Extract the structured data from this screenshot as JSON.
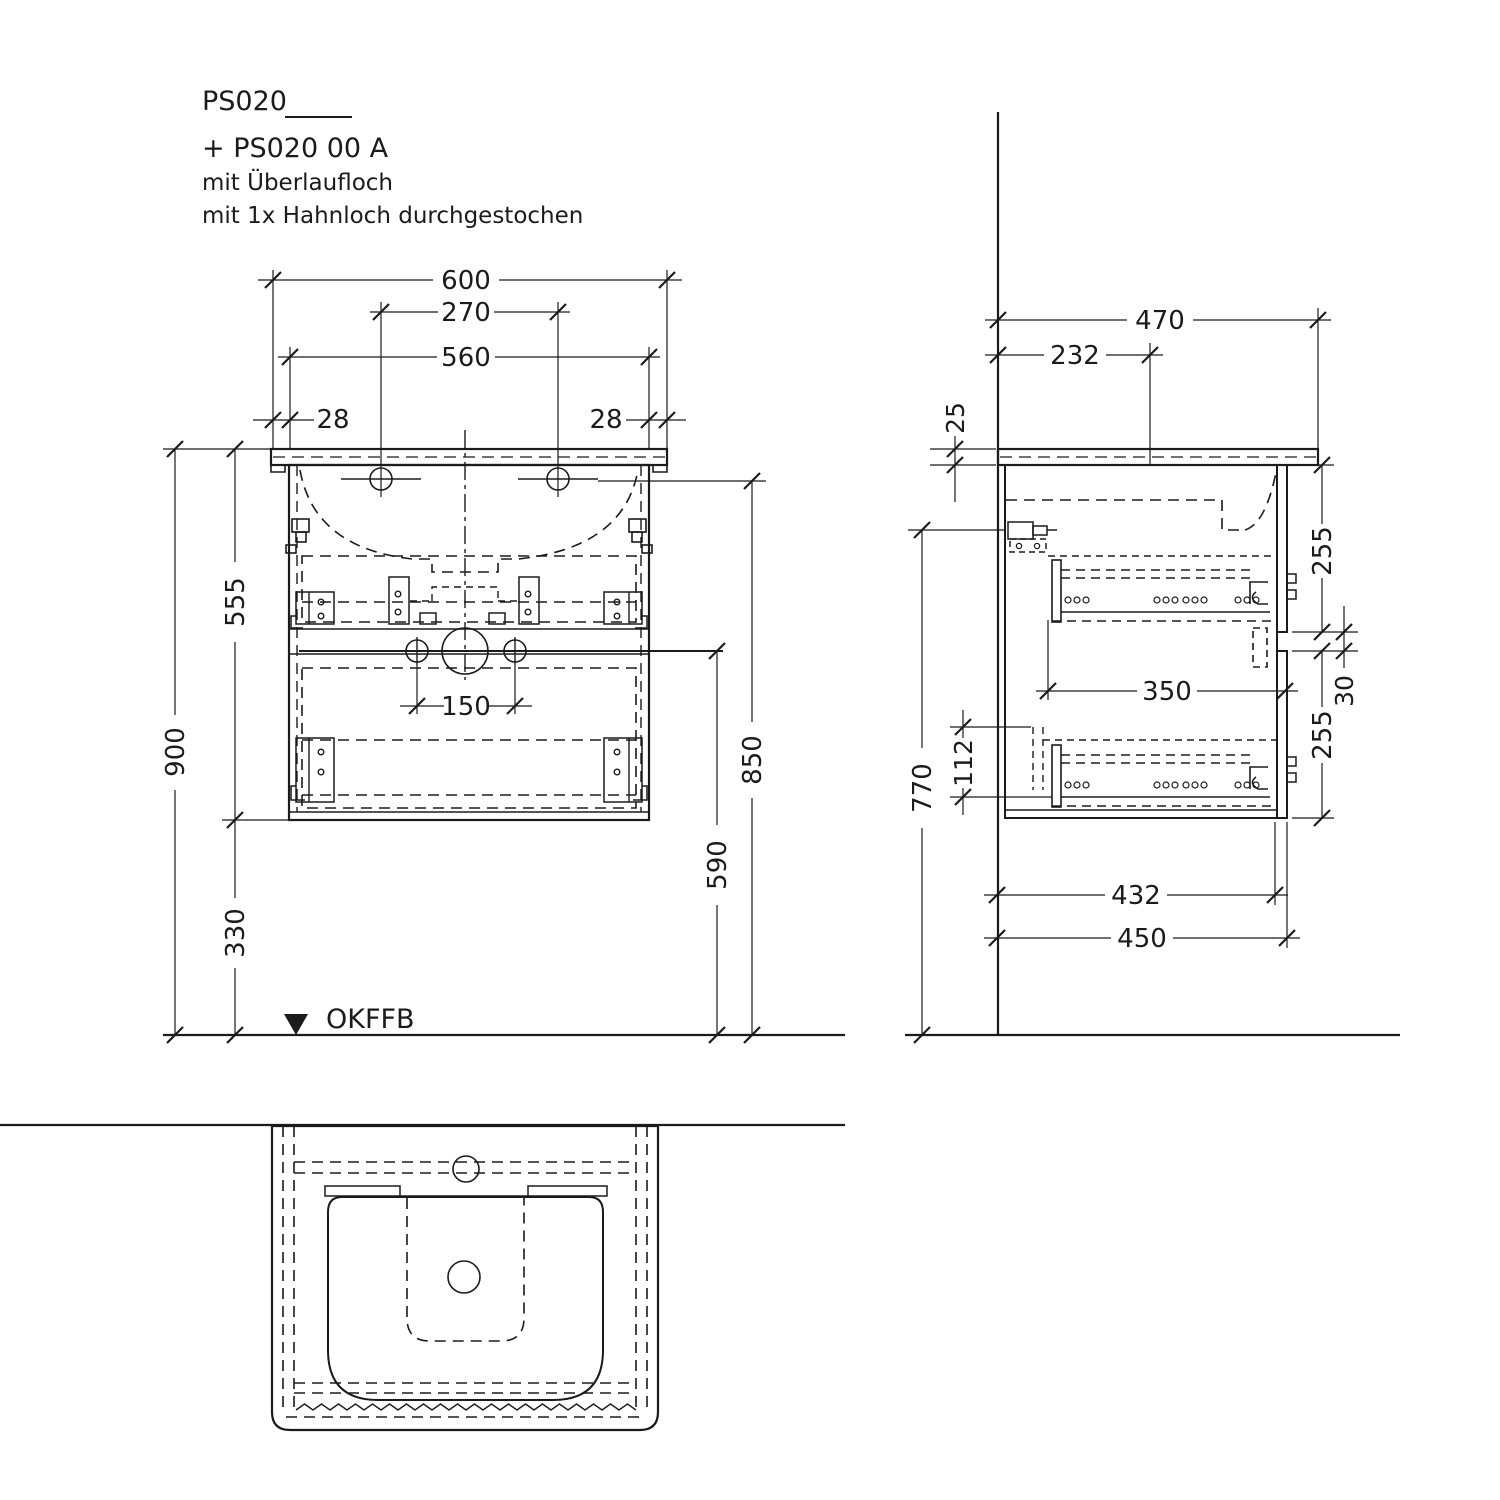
{
  "drawing": {
    "title": {
      "product_code": "PS020",
      "product_code_suffix": "+ PS020 00 A",
      "note_overflow": "mit Überlaufloch",
      "note_tap_hole": "mit 1x Hahnloch durchgestochen"
    },
    "floor_reference": "OKFFB",
    "front_dims": {
      "total_width": "600",
      "tap_spacing": "270",
      "body_width": "560",
      "overhang_left": "28",
      "overhang_right": "28",
      "body_height": "555",
      "total_height": "900",
      "floor_clearance": "330",
      "outlet_spacing": "150",
      "outlet_height": "590",
      "hanger_height": "850"
    },
    "side_dims": {
      "total_depth": "470",
      "tap_depth": "232",
      "top_thickness": "25",
      "upper_front_height": "255",
      "front_gap": "30",
      "lower_front_height": "255",
      "hanger_height": "770",
      "lower_clearance": "112",
      "drawer_depth": "350",
      "inner_depth": "432",
      "body_depth": "450"
    },
    "colors": {
      "ink": "#1b1b1b",
      "background": "#ffffff"
    }
  }
}
